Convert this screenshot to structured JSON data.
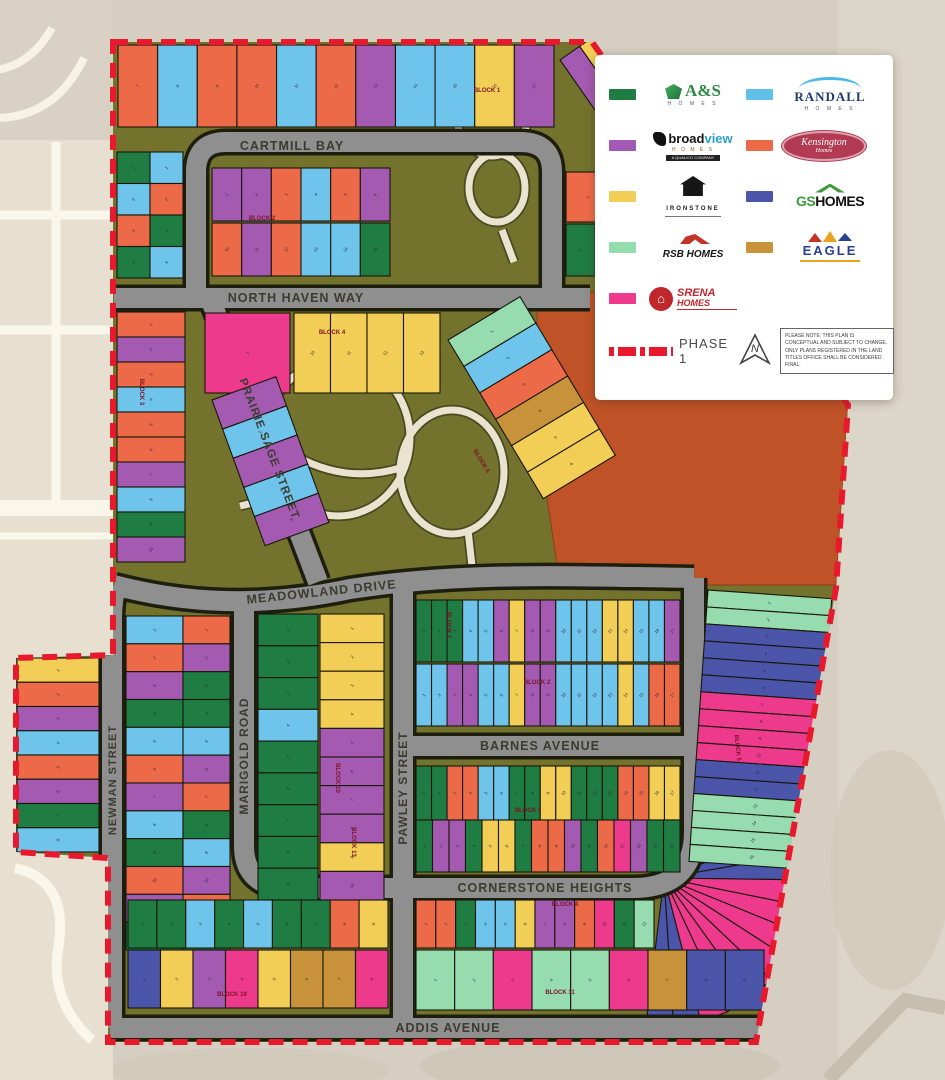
{
  "legend": {
    "builders": [
      {
        "name": "A&S",
        "sub": "H O M E S",
        "color": "#1f7c42"
      },
      {
        "name": "RANDALL",
        "sub": "H O M E S",
        "color": "#5fc0e8"
      },
      {
        "name1": "broad",
        "name2": "view",
        "sub": "H O M E S",
        "micro": "A QUALICO COMPANY",
        "color": "#a35ab4"
      },
      {
        "name": "Kensington",
        "sub": "Homes",
        "color": "#ed6a49"
      },
      {
        "name": "IRONSTONE",
        "color": "#f2ce57"
      },
      {
        "name1": "GS",
        "name2": "HOMES",
        "color": "#4b55a9"
      },
      {
        "name": "RSB HOMES",
        "color": "#93dcab"
      },
      {
        "name": "EAGLE",
        "color": "#c8923b"
      },
      {
        "name1": "SRENA",
        "name2": "HOMES",
        "color": "#ee3a8c"
      }
    ],
    "phase_label": "PHASE 1",
    "north_label": "N",
    "note": "PLEASE NOTE: THIS PLAN IS CONCEPTUAL AND SUBJECT TO CHANGE. ONLY PLANS REGISTERED IN THE LAND TITLES OFFICE SHALL BE CONSIDERED FINAL.",
    "srena_house_glyph": "⌂"
  },
  "map": {
    "palette": {
      "G": "#1f7c42",
      "B": "#6ec4ea",
      "P": "#a55ab2",
      "O": "#ed6a49",
      "Y": "#f2ce57",
      "I": "#4b55a9",
      "L": "#97dcae",
      "E": "#c8923b",
      "K": "#ee3a8c"
    },
    "streets": [
      {
        "label": "CARTMILL BAY",
        "x": 292,
        "y": 150,
        "rot": 0,
        "size": 12.5
      },
      {
        "label": "NORTH HAVEN WAY",
        "x": 296,
        "y": 302,
        "rot": 0,
        "size": 12.5
      },
      {
        "label": "PRAIRIE SAGE STREET",
        "x": 266,
        "y": 450,
        "rot": 69,
        "size": 11.5
      },
      {
        "label": "MEADOWLAND DRIVE",
        "x": 322,
        "y": 596,
        "rot": -6,
        "size": 12.5
      },
      {
        "label": "PAWLEY STREET",
        "x": 407,
        "y": 788,
        "rot": -90,
        "size": 12
      },
      {
        "label": "MARIGOLD ROAD",
        "x": 248,
        "y": 756,
        "rot": -90,
        "size": 12
      },
      {
        "label": "NEWMAN STREET",
        "x": 116,
        "y": 780,
        "rot": -90,
        "size": 11
      },
      {
        "label": "BARNES AVENUE",
        "x": 540,
        "y": 750,
        "rot": 0,
        "size": 12.5
      },
      {
        "label": "CORNERSTONE HEIGHTS",
        "x": 545,
        "y": 892,
        "rot": 0,
        "size": 12.5
      },
      {
        "label": "ADDIS AVENUE",
        "x": 448,
        "y": 1032,
        "rot": 0,
        "size": 12.5
      }
    ],
    "block_labels": [
      {
        "label": "BLOCK 1",
        "x": 487,
        "y": 92,
        "rot": 0
      },
      {
        "label": "BLOCK 2",
        "x": 262,
        "y": 220,
        "rot": 0
      },
      {
        "label": "BLOCK 3",
        "x": 140,
        "y": 392,
        "rot": 90
      },
      {
        "label": "BLOCK 4",
        "x": 332,
        "y": 334,
        "rot": 0
      },
      {
        "label": "BLOCK 5",
        "x": 480,
        "y": 462,
        "rot": 59
      },
      {
        "label": "BLOCK 1",
        "x": 447,
        "y": 625,
        "rot": 90
      },
      {
        "label": "BLOCK 2",
        "x": 537,
        "y": 684,
        "rot": 0
      },
      {
        "label": "BLOCK 3",
        "x": 528,
        "y": 812,
        "rot": 0
      },
      {
        "label": "BLOCK 10",
        "x": 336,
        "y": 778,
        "rot": 90
      },
      {
        "label": "BLOCK 13",
        "x": 352,
        "y": 842,
        "rot": 90
      },
      {
        "label": "BLOCK 4",
        "x": 565,
        "y": 906,
        "rot": 0
      },
      {
        "label": "BLOCK 11",
        "x": 560,
        "y": 994,
        "rot": 0
      },
      {
        "label": "BLOCK 19",
        "x": 232,
        "y": 996,
        "rot": 0
      },
      {
        "label": "BLOCK 5",
        "x": 736,
        "y": 748,
        "rot": 84
      }
    ],
    "lot_strips": [
      {
        "x": 118,
        "y": 45,
        "w": 436,
        "h": 82,
        "dir": "h",
        "start": 7,
        "colors": [
          "O",
          "B",
          "O",
          "O",
          "B",
          "O",
          "P",
          "B",
          "B",
          "Y",
          "P"
        ]
      },
      {
        "x": 560,
        "y": 60,
        "w": 96,
        "h": 110,
        "dir": "h",
        "rot": -35,
        "colors": [
          "P",
          "Y",
          "O",
          "Y"
        ]
      },
      {
        "x": 117,
        "y": 152,
        "w": 33,
        "h": 126,
        "dir": "v",
        "colors": [
          "G",
          "B",
          "O",
          "G"
        ]
      },
      {
        "x": 150,
        "y": 152,
        "w": 33,
        "h": 126,
        "dir": "v",
        "colors": [
          "B",
          "O",
          "G",
          "B"
        ]
      },
      {
        "x": 212,
        "y": 168,
        "w": 178,
        "h": 53,
        "dir": "h",
        "colors": [
          "P",
          "P",
          "O",
          "B",
          "O",
          "P"
        ]
      },
      {
        "x": 212,
        "y": 223,
        "w": 178,
        "h": 53,
        "dir": "h",
        "start": 10,
        "colors": [
          "O",
          "P",
          "O",
          "B",
          "B",
          "G"
        ]
      },
      {
        "x": 566,
        "y": 172,
        "w": 88,
        "h": 50,
        "dir": "h",
        "colors": [
          "O",
          "O"
        ]
      },
      {
        "x": 566,
        "y": 224,
        "w": 88,
        "h": 52,
        "dir": "h",
        "colors": [
          "G",
          "B",
          "G"
        ]
      },
      {
        "x": 205,
        "y": 313,
        "w": 85,
        "h": 80,
        "dir": "h",
        "colors": [
          "K"
        ]
      },
      {
        "x": 294,
        "y": 313,
        "w": 146,
        "h": 80,
        "dir": "h",
        "start": 10,
        "colors": [
          "Y",
          "Y",
          "Y",
          "Y"
        ]
      },
      {
        "x": 117,
        "y": 312,
        "w": 68,
        "h": 250,
        "dir": "v",
        "colors": [
          "O",
          "P",
          "O",
          "B",
          "O",
          "O",
          "P",
          "B",
          "G",
          "P"
        ]
      },
      {
        "x": 212,
        "y": 400,
        "w": 68,
        "h": 155,
        "dir": "v",
        "rot": -20,
        "colors": [
          "P",
          "B",
          "P",
          "B",
          "P"
        ]
      },
      {
        "x": 448,
        "y": 340,
        "w": 84,
        "h": 185,
        "dir": "v",
        "rot": -31,
        "colors": [
          "L",
          "B",
          "O",
          "E",
          "Y",
          "Y"
        ]
      },
      {
        "x": 17,
        "y": 658,
        "w": 82,
        "h": 194,
        "dir": "v",
        "colors": [
          "Y",
          "O",
          "P",
          "B",
          "O",
          "P",
          "G",
          "B"
        ]
      },
      {
        "x": 126,
        "y": 616,
        "w": 57,
        "h": 334,
        "dir": "v",
        "colors": [
          "B",
          "O",
          "P",
          "G",
          "B",
          "O",
          "P",
          "B",
          "G",
          "O",
          "P",
          "G"
        ]
      },
      {
        "x": 183,
        "y": 616,
        "w": 47,
        "h": 334,
        "dir": "v",
        "colors": [
          "O",
          "P",
          "G",
          "G",
          "B",
          "P",
          "O",
          "G",
          "B",
          "P",
          "O",
          "G"
        ]
      },
      {
        "x": 258,
        "y": 614,
        "w": 60,
        "h": 286,
        "dir": "v",
        "colors": [
          "G",
          "G",
          "G",
          "B",
          "G",
          "G",
          "G",
          "G",
          "G"
        ]
      },
      {
        "x": 320,
        "y": 614,
        "w": 64,
        "h": 286,
        "dir": "v",
        "colors": [
          "Y",
          "Y",
          "Y",
          "Y",
          "P",
          "P",
          "P",
          "P",
          "Y",
          "P"
        ]
      },
      {
        "x": 416,
        "y": 600,
        "w": 264,
        "h": 62,
        "dir": "h",
        "colors": [
          "G",
          "G",
          "G",
          "B",
          "B",
          "P",
          "Y",
          "P",
          "P",
          "B",
          "B",
          "B",
          "Y",
          "Y",
          "B",
          "B",
          "P"
        ]
      },
      {
        "x": 416,
        "y": 664,
        "w": 264,
        "h": 62,
        "dir": "h",
        "colors": [
          "B",
          "B",
          "P",
          "P",
          "B",
          "B",
          "Y",
          "P",
          "P",
          "B",
          "B",
          "B",
          "B",
          "Y",
          "B",
          "O",
          "O"
        ]
      },
      {
        "x": 416,
        "y": 766,
        "w": 264,
        "h": 54,
        "dir": "h",
        "colors": [
          "G",
          "G",
          "O",
          "O",
          "B",
          "B",
          "G",
          "G",
          "Y",
          "Y",
          "G",
          "G",
          "G",
          "O",
          "O",
          "Y",
          "Y"
        ]
      },
      {
        "x": 416,
        "y": 820,
        "w": 264,
        "h": 52,
        "dir": "h",
        "colors": [
          "G",
          "P",
          "P",
          "G",
          "Y",
          "Y",
          "G",
          "O",
          "O",
          "P",
          "G",
          "O",
          "K",
          "P",
          "G",
          "G"
        ]
      },
      {
        "x": 416,
        "y": 900,
        "w": 238,
        "h": 48,
        "dir": "h",
        "colors": [
          "O",
          "O",
          "G",
          "B",
          "B",
          "Y",
          "P",
          "P",
          "O",
          "K",
          "G",
          "L"
        ]
      },
      {
        "x": 416,
        "y": 950,
        "w": 348,
        "h": 60,
        "dir": "h",
        "colors": [
          "L",
          "L",
          "K",
          "L",
          "L",
          "K",
          "E",
          "I",
          "I"
        ]
      },
      {
        "x": 128,
        "y": 900,
        "w": 260,
        "h": 48,
        "dir": "h",
        "colors": [
          "G",
          "G",
          "B",
          "G",
          "B",
          "G",
          "G",
          "O",
          "Y"
        ]
      },
      {
        "x": 128,
        "y": 950,
        "w": 260,
        "h": 58,
        "dir": "h",
        "colors": [
          "I",
          "Y",
          "P",
          "K",
          "Y",
          "E",
          "E",
          "K"
        ]
      },
      {
        "x": 708,
        "y": 590,
        "w": 124,
        "h": 272,
        "dir": "v",
        "rot": 4,
        "colors": [
          "L",
          "L",
          "I",
          "I",
          "I",
          "I",
          "K",
          "K",
          "K",
          "K",
          "I",
          "I",
          "L",
          "L",
          "L",
          "L"
        ]
      }
    ],
    "fans": [
      {
        "cx": 664,
        "cy": 878,
        "r": 148,
        "a0": -42,
        "a1": 97,
        "colors": [
          "L",
          "L",
          "I",
          "I",
          "K",
          "K",
          "K",
          "K",
          "K",
          "K",
          "K",
          "I",
          "I"
        ]
      }
    ]
  }
}
